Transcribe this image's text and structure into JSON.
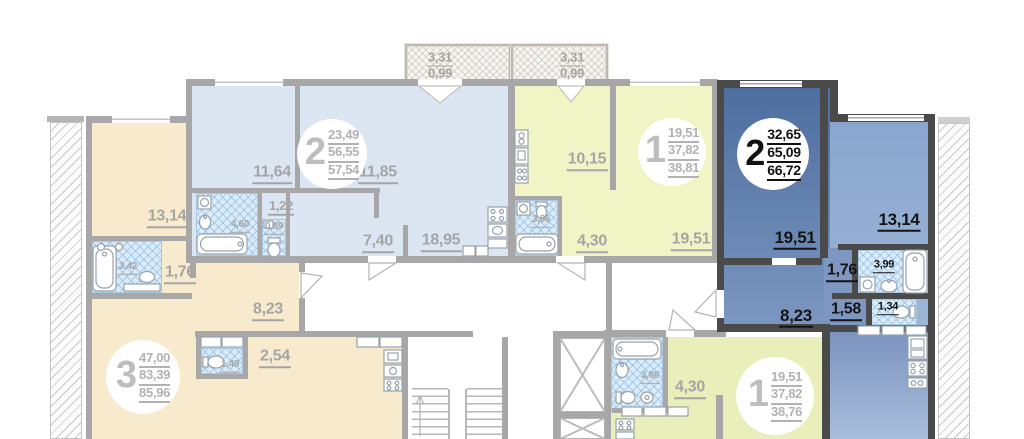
{
  "balconies": {
    "left": {
      "area": "3,31",
      "reduced": "0,99"
    },
    "right": {
      "area": "3,31",
      "reduced": "0,99"
    }
  },
  "apartments": {
    "a": {
      "number": "2",
      "living": "23,49",
      "area": "56,55",
      "total": "57,54",
      "rooms": {
        "bedroom1": "11,64",
        "bedroom2": "11,85",
        "hall": "1,22",
        "bath": "4,60",
        "wc": "0,89",
        "corridor": "7,40",
        "kitchen_living": "18,95"
      }
    },
    "b": {
      "number": "1",
      "living": "19,51",
      "area": "37,82",
      "total": "38,81",
      "rooms": {
        "kitchen": "10,15",
        "bath": "3,86",
        "hall": "4,30",
        "room": "19,51"
      }
    },
    "c": {
      "number": "2",
      "living": "32,65",
      "area": "65,09",
      "total": "66,72",
      "rooms": {
        "room1": "19,51",
        "room2": "13,14",
        "hall1": "1,76",
        "bath": "3,99",
        "hall2": "1,58",
        "wc": "1,34",
        "hall3": "8,23"
      }
    },
    "d": {
      "number": "3",
      "living": "47,00",
      "area": "83,39",
      "total": "85,96",
      "rooms": {
        "bedroom": "13,14",
        "bath": "3,42",
        "hall1": "1,76",
        "hall2": "8,23",
        "wardrobe": "2,54",
        "wc": "1,49"
      }
    },
    "e": {
      "number": "1",
      "living": "19,51",
      "area": "37,82",
      "total": "38,76",
      "rooms": {
        "bath": "3,86",
        "hall": "4,30"
      }
    }
  },
  "palette": {
    "highlight": "#4d6e9f",
    "walls": "#a7a7a7",
    "walls_dark": "#4a4a4a"
  }
}
